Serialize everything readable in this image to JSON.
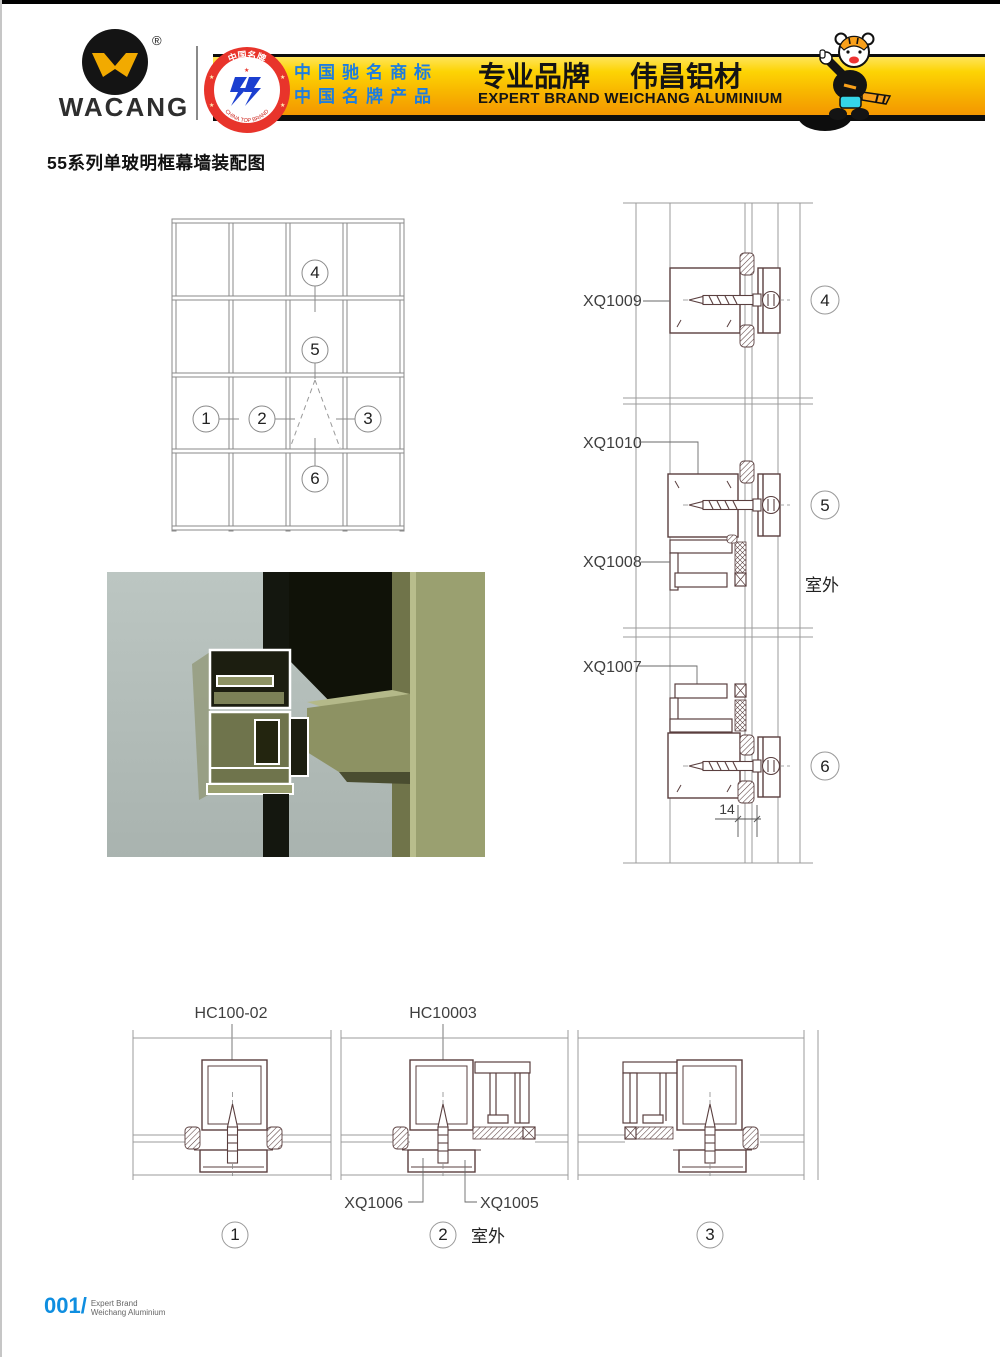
{
  "header": {
    "logo": {
      "name": "WACANG",
      "registered_mark": "®"
    },
    "badge": {
      "arc_top": "中国名牌",
      "arc_bottom": "CHINA TOP BRAND"
    },
    "banner": {
      "credential_line1": "中国驰名商标",
      "credential_line2": "中国名牌产品",
      "slogan_cn_left": "专业品牌",
      "slogan_cn_right": "伟昌铝材",
      "slogan_en": "EXPERT BRAND WEICHANG ALUMINIUM"
    },
    "colors": {
      "banner_top": "#fdd404",
      "banner_bottom": "#f49600",
      "credential_blue": "#1d7de0",
      "badge_red": "#e8342b",
      "logo_yellow": "#f2aa00"
    }
  },
  "page": {
    "title": "55系列单玻明框幕墙装配图"
  },
  "elevation": {
    "callouts": {
      "c1": "1",
      "c2": "2",
      "c3": "3",
      "c4": "4",
      "c5": "5",
      "c6": "6"
    }
  },
  "right_details": {
    "d4": {
      "callout": "4",
      "label": "XQ1009"
    },
    "d5": {
      "callout": "5",
      "label_top": "XQ1010",
      "label_bottom": "XQ1008",
      "outdoor": "室外"
    },
    "d6": {
      "callout": "6",
      "label": "XQ1007",
      "dimension": "14"
    }
  },
  "bottom_details": {
    "d1": {
      "callout": "1",
      "label": "HC100-02"
    },
    "d2": {
      "callout": "2",
      "label_top": "HC10003",
      "label_left": "XQ1006",
      "label_right": "XQ1005",
      "outdoor": "室外"
    },
    "d3": {
      "callout": "3"
    }
  },
  "footer": {
    "page_number": "001/",
    "brand_line1": "Expert Brand",
    "brand_line2": "Weichang Aluminium"
  }
}
